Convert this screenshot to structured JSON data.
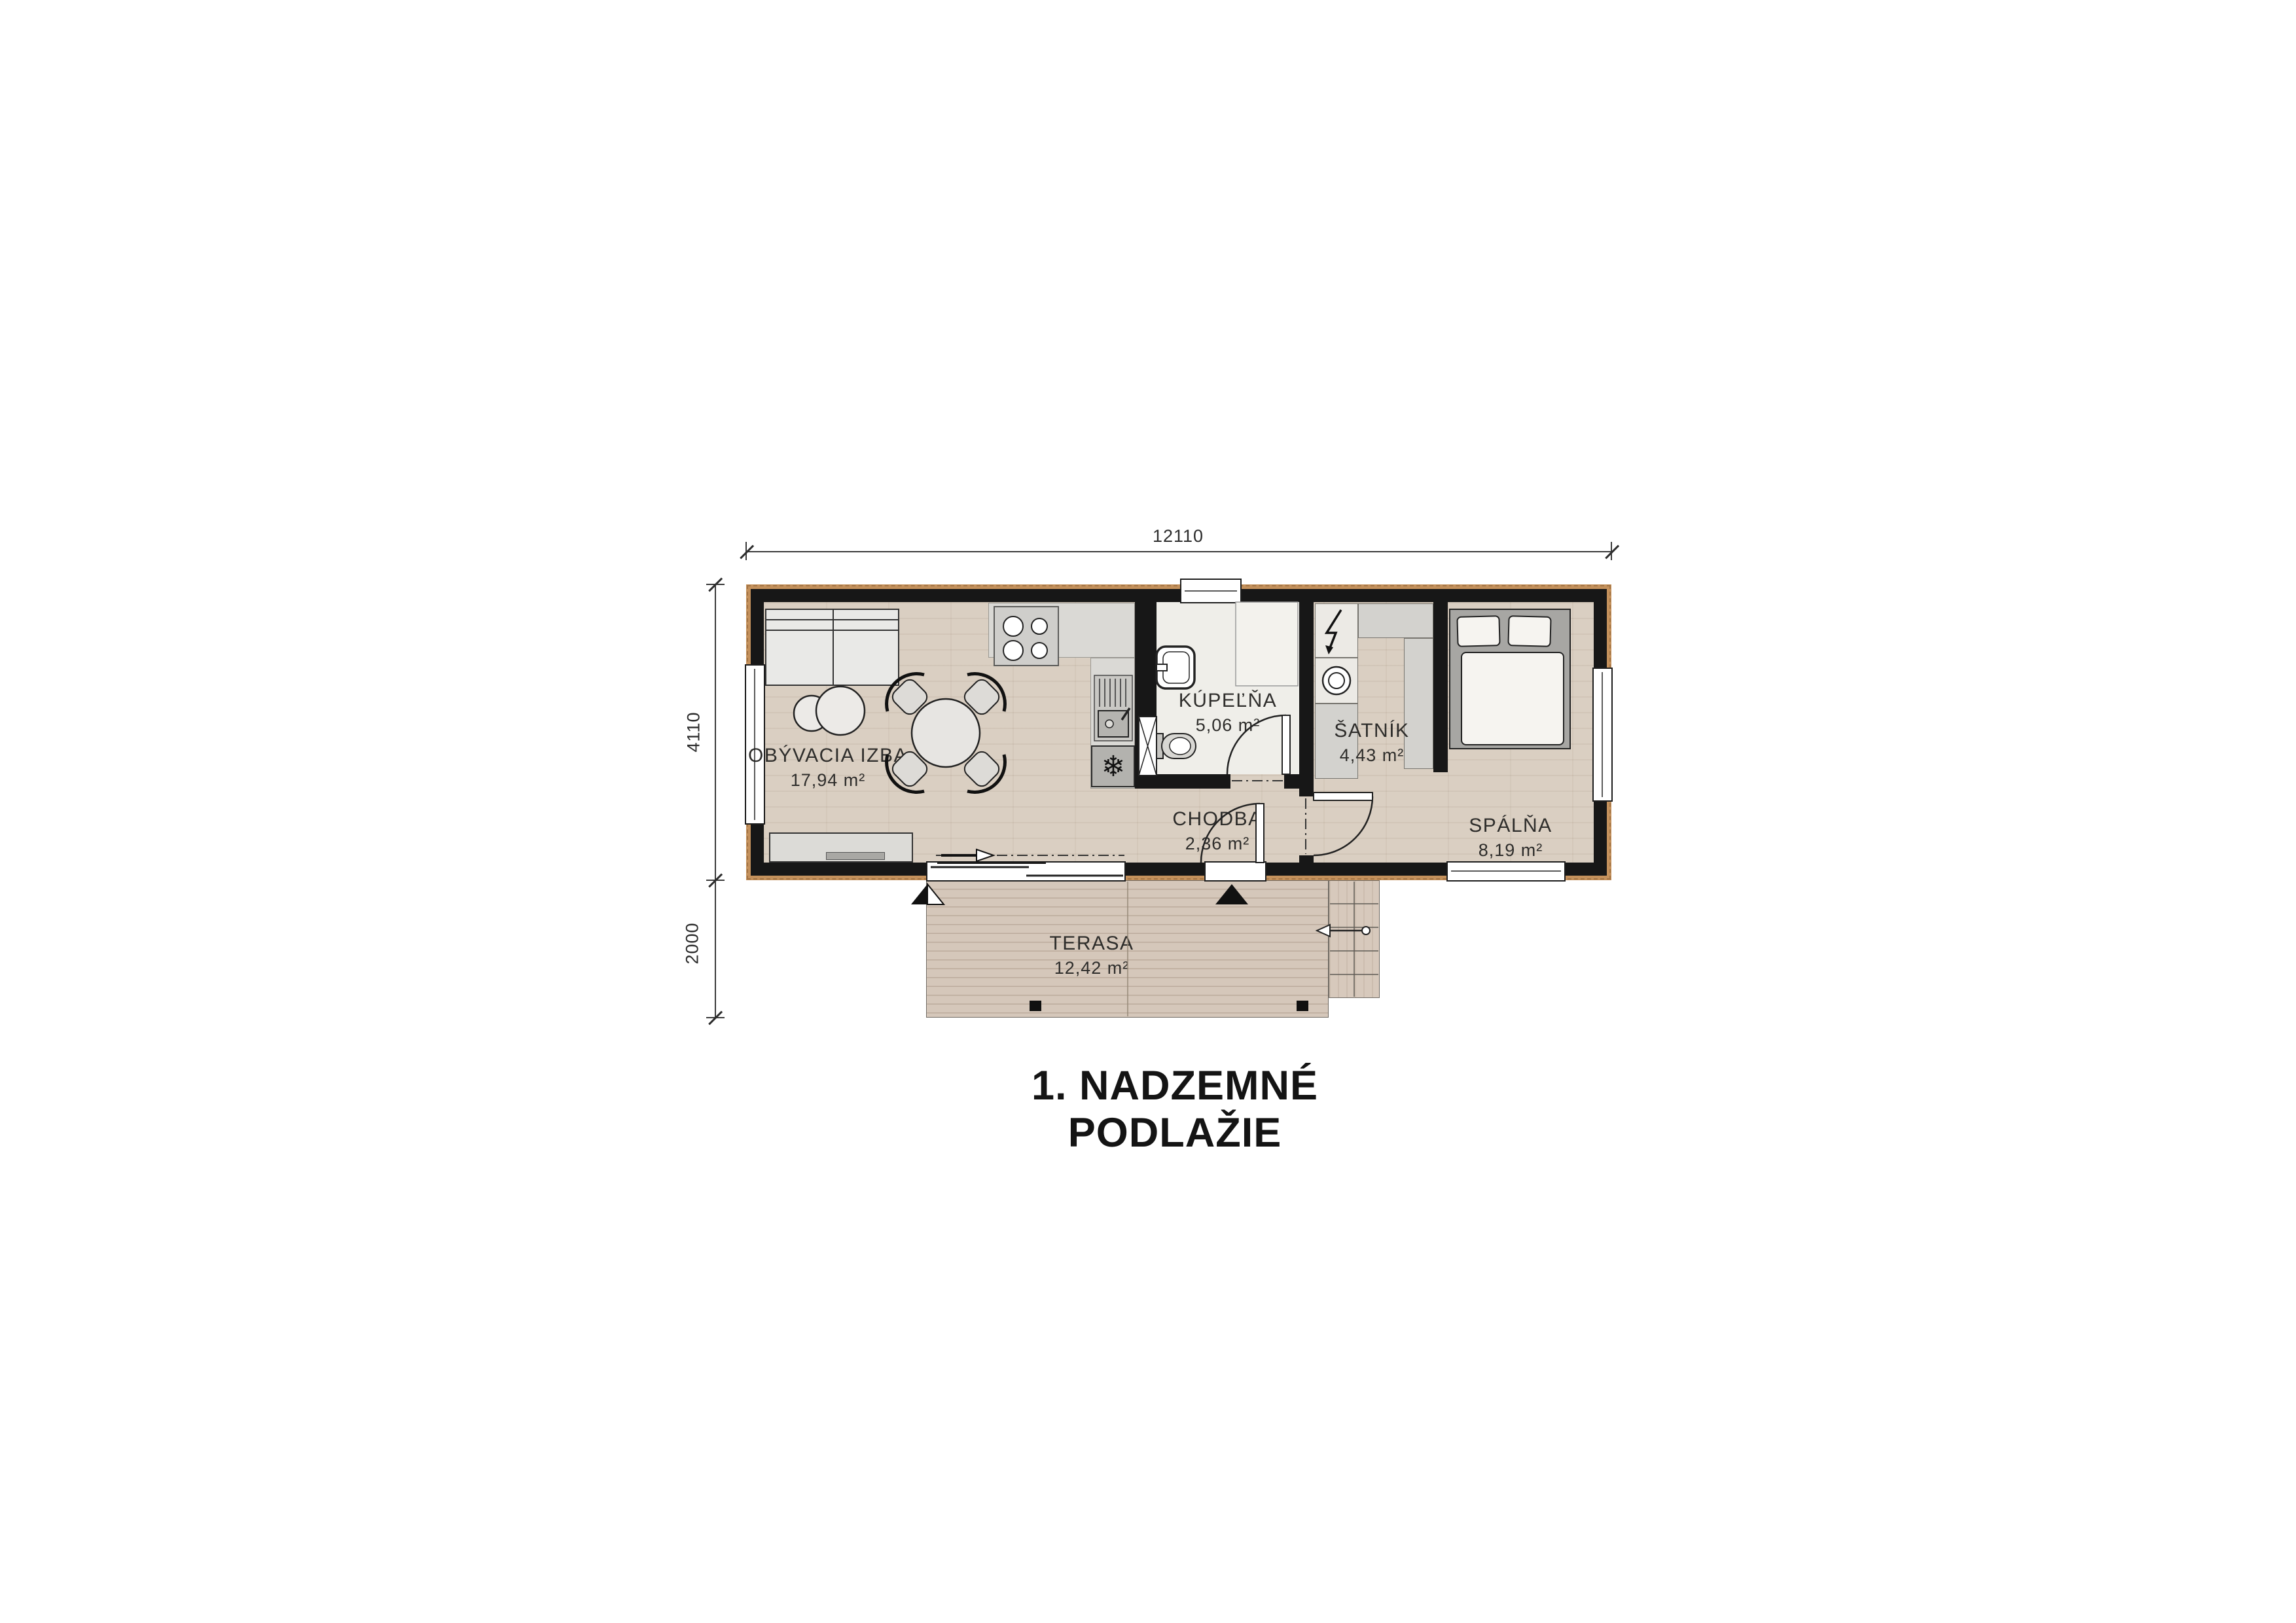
{
  "title": "1. NADZEMNÉ PODLAŽIE",
  "dimensions": {
    "total_width": "12110",
    "house_depth": "4110",
    "terrace_depth": "2000"
  },
  "rooms": [
    {
      "name": "OBÝVACIA IZBA",
      "area": "17,94 m²"
    },
    {
      "name": "KÚPEĽŇA",
      "area": "5,06 m²"
    },
    {
      "name": "ŠATNÍK",
      "area": "4,43 m²"
    },
    {
      "name": "CHODBA",
      "area": "2,36 m²"
    },
    {
      "name": "SPÁLŇA",
      "area": "8,19 m²"
    },
    {
      "name": "TERASA",
      "area": "12,42 m²"
    }
  ],
  "icons": {
    "fridge": "snowflake-icon",
    "electric_panel": "lightning-icon",
    "stair_direction": "arrow-left-icon",
    "slide_direction": "arrow-right-icon"
  },
  "colors": {
    "wall": "#171717",
    "cladding": "#c4915c",
    "floor_wood": "#dacfc2",
    "terrace_wood": "#d2c3b5",
    "fixture_gray": "#d3d2ce",
    "bathroom_floor": "#efeee9",
    "background": "#ffffff"
  }
}
